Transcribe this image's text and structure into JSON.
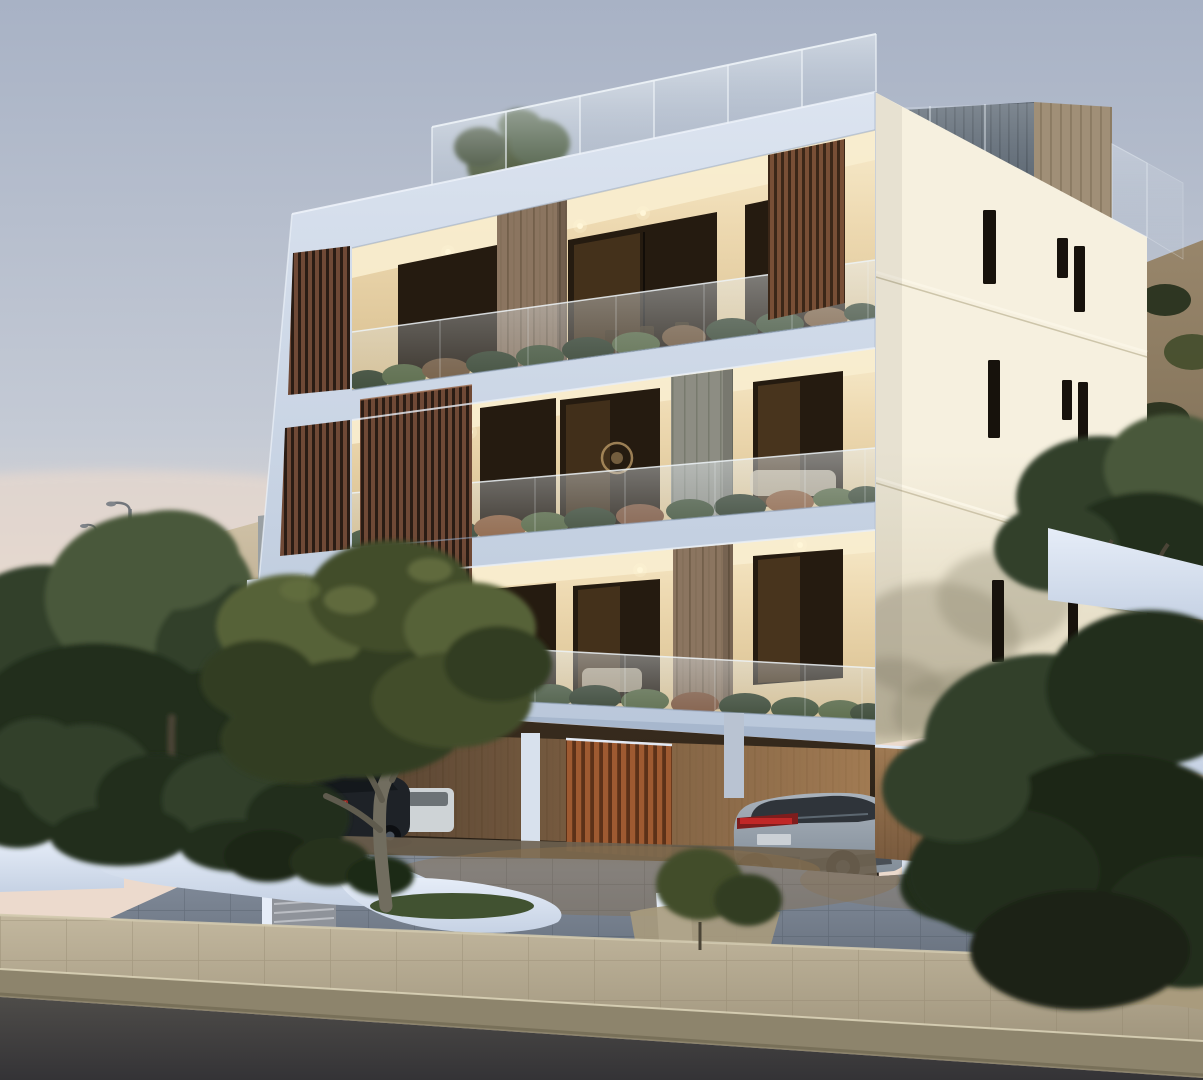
{
  "scene": {
    "kind": "architectural-3d-render",
    "time_of_day": "dusk",
    "subject": "modern white three-storey apartment building with recessed balconies, wood louver screens, rooftop glass balustrade terrace and open ground-floor carport",
    "floors_visible": 3,
    "balconies": {
      "glass_balustrades": true,
      "planters_with_shrubs": true,
      "warm_interior_lighting": true
    },
    "facades": {
      "front": "cool white frames with recessed lit balconies",
      "side": "cream wall with narrow vertical slit windows and cast tree shadow"
    },
    "roof": {
      "glass_balustrade_panels": 6,
      "stair_boxes": [
        "dark grey plank box",
        "tan plank box"
      ],
      "small_tree": true
    },
    "carport": {
      "wood_clad_back_wall": true,
      "freestanding_wood_slat_partition": true,
      "white_columns": 4
    },
    "vehicles": [
      {
        "type": "dark sedan",
        "feature": "red tail lights lit"
      },
      {
        "type": "white car",
        "feature": "partially hidden"
      },
      {
        "type": "silver SUV",
        "feature": "red tail light bar, parked under building"
      }
    ],
    "landscape": [
      "sandy hillside with scrub",
      "two street lamps",
      "olive tree in curved white planter",
      "dark green shrubs and trees",
      "white curved planter walls",
      "entry steps"
    ],
    "foreground": [
      "grey block-paved driveway",
      "concrete paver sidewalk",
      "concrete curb",
      "dark asphalt road"
    ]
  },
  "colors": {
    "sky_top": "#a8b2c5",
    "sky_mid": "#c4cad5",
    "sky_low": "#dad5d3",
    "sky_pink": "#ecdacd",
    "sand_hi": "#cfc1a6",
    "sand": "#b4a489",
    "sand_lo": "#97886d",
    "wall_grey": "#9aa0a3",
    "lamp": "#71757b",
    "hillR_hi": "#98866b",
    "hillR_lo": "#6f6049",
    "tree_d": "#232e1b",
    "tree_m": "#32402a",
    "tree_l": "#49583a",
    "olive_d": "#333d24",
    "olive_m": "#424d2b",
    "olive_l": "#576238",
    "olive_hi": "#6d7847",
    "trunk": "#716d5f",
    "front_hi": "#dce4f0",
    "front_lo": "#b9c7da",
    "front_edge": "#edf2f9",
    "band_sh": "#93a5bf",
    "cream_hi": "#f6f0df",
    "cream_lo": "#ddd4ba",
    "cream_line": "#c9c0a4",
    "cream_slab": "#faf5e6",
    "slit": "#17120c",
    "roofD": "#5a646f",
    "roofDs": "#49525c",
    "roofT": "#a08f77",
    "roofTs": "#8b7b63",
    "glassA": "#edf3f7",
    "glassB": "#c8d6df",
    "intCeil": "#f8edcf",
    "intA": "#eedab2",
    "intB": "#d5bb8a",
    "winD": "#251b10",
    "winGlow": "#6b4d2a",
    "plank": "#8b7560",
    "plankD": "#73604b",
    "plankG": "#8d8d83",
    "plankGD": "#787a6e",
    "slat": "#6f4936",
    "slatG": "#2a1c14",
    "slatR": "#9e5a31",
    "slatRG": "#5c3118",
    "light": "#fff6d8",
    "art": "#c2a06b",
    "sofa": "#d8ccb3",
    "cwA": "#3c2c1e",
    "cwB": "#a87c4e",
    "colW": "#d8e1ed",
    "soff": "#e2e9f4",
    "paveA": "#828c9b",
    "paveB": "#5f6874",
    "paveJ": "#4d5560",
    "paveWarm": "#8a6f4b",
    "ramp": "#dbe3ef",
    "plantA": "#e6edf8",
    "plantB": "#c6d2e4",
    "plantC": "#a9bacf",
    "grass": "#415231",
    "step": "#8f939a",
    "stepL": "#c0c3c9",
    "sandM": "#a99b7d",
    "walkA": "#c2b79e",
    "walkB": "#a1967e",
    "walkL": "#8e8269",
    "curbA": "#d2c9ae",
    "curb": "#8d846c",
    "curbD": "#6b634c",
    "asphA": "#4e4c49",
    "asphB": "#343336",
    "carD": "#1e2227",
    "carW": "#ced3d6",
    "rrA": "#a9b2bc",
    "rrB": "#7d8893",
    "rrG": "#2f343a",
    "tail": "#c42828",
    "tailD": "#7e1d1d",
    "wheel": "#0d0f12",
    "rim": "#4b535d",
    "bayA": "#ecd8ae",
    "bayB": "#c9a269"
  }
}
